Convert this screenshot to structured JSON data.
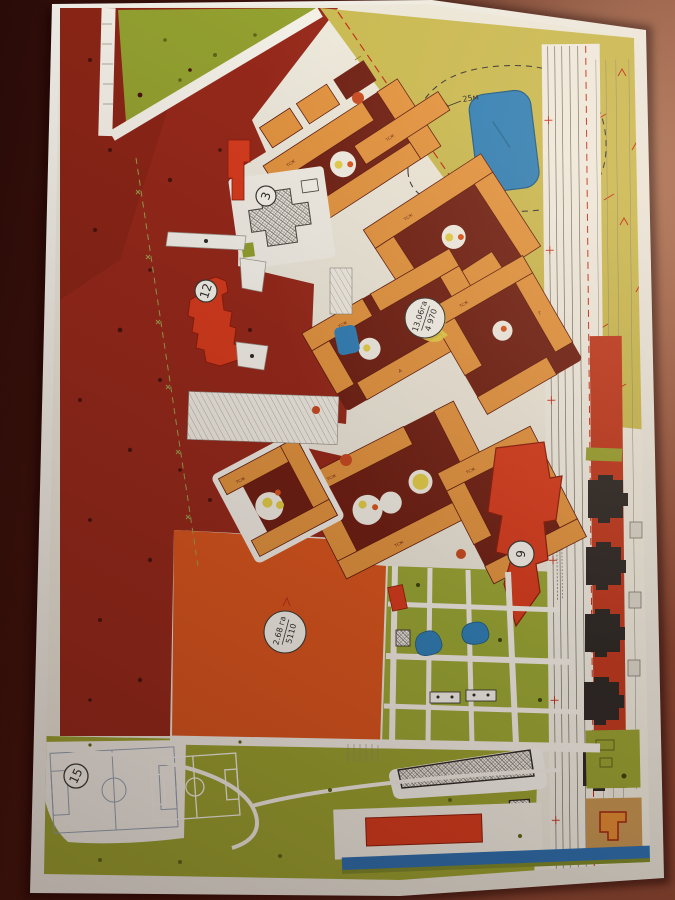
{
  "document": {
    "type": "printed master plan sheet (photographed on dark table)",
    "labels": {
      "circled": {
        "school": "3",
        "arrow_building": "9",
        "building_12": "12",
        "stadium": "15"
      },
      "pond_width": "25м",
      "district_area": {
        "line1": "13.06га",
        "line2": "4 970"
      },
      "field_area": {
        "line1": "2.68 га",
        "line2": "5110"
      },
      "building_marker": "ТСЖ",
      "building_letters": [
        "А",
        "Б",
        "В",
        "Г"
      ]
    },
    "colors": {
      "table_dark": "#30100b",
      "table_light": "#8a4631",
      "paper": "#f0ede5",
      "map_base": "#ece8db",
      "zone_dark_red": "#96291b",
      "zone_orange_field": "#d9561f",
      "zone_olive": "#93a130",
      "zone_yellow": "#c9ba52",
      "zone_tan": "#c59552",
      "building_orange": "#e29440",
      "building_maroon": "#6f2014",
      "building_red": "#d63c1e",
      "building_black": "#2e2a27",
      "water_blue": "#2f80b8",
      "playground_yellow": "#e3cf49",
      "red_line": "#c22c18"
    }
  }
}
